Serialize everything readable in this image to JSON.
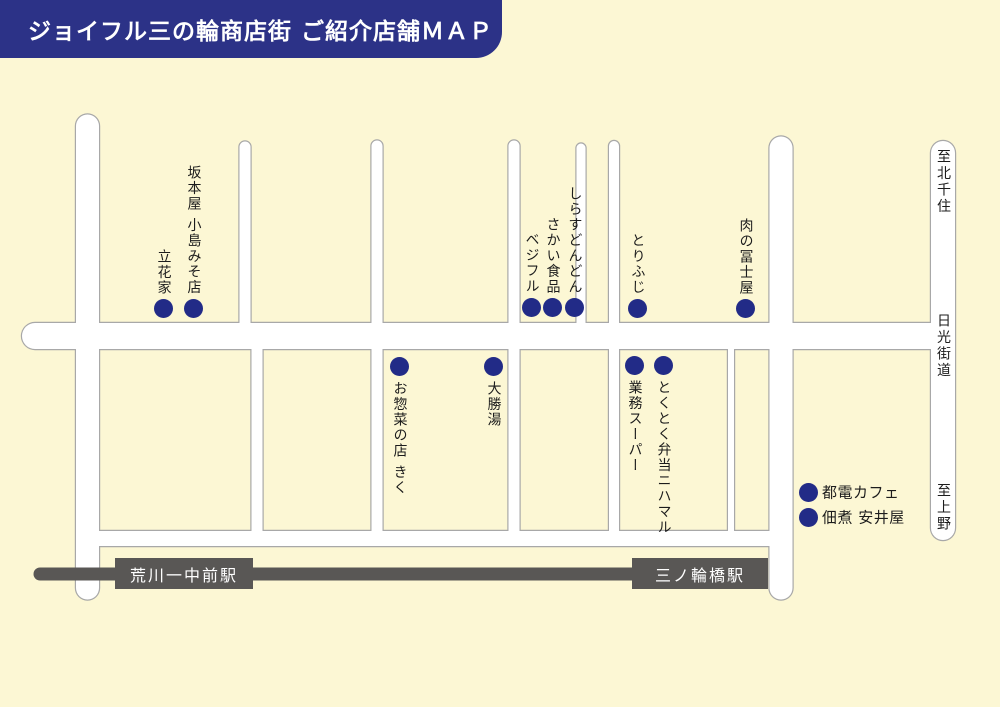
{
  "header": {
    "title": "ジョイフル三の輪商店街 ご紹介店舗ＭＡＰ"
  },
  "colors": {
    "background": "#fcf7d4",
    "dot_navy": "#222b87",
    "header_navy": "#2c3287",
    "road_fill": "#ffffff",
    "road_casing": "#a8a8a8",
    "rail_gray": "#595755",
    "label_ink": "#1c1c1c",
    "station_text": "#ffffff"
  },
  "stores": [
    {
      "name": "立花家",
      "dot_x": 163,
      "dot_y": 308,
      "label_style": "vertical-above"
    },
    {
      "name": "坂本屋 小島みそ店",
      "dot_x": 193,
      "dot_y": 308,
      "label_style": "vertical-above"
    },
    {
      "name": "ベジフル",
      "dot_x": 531,
      "dot_y": 307,
      "label_style": "vertical-above"
    },
    {
      "name": "さかい食品",
      "dot_x": 552,
      "dot_y": 307,
      "label_style": "vertical-above"
    },
    {
      "name": "しらすどんどん",
      "dot_x": 574,
      "dot_y": 307,
      "label_style": "vertical-above"
    },
    {
      "name": "とりふじ",
      "dot_x": 637,
      "dot_y": 308,
      "label_style": "vertical-above"
    },
    {
      "name": "肉の冨士屋",
      "dot_x": 745,
      "dot_y": 308,
      "label_style": "vertical-above"
    },
    {
      "name": "お惣菜の店 きく",
      "dot_x": 399,
      "dot_y": 366,
      "label_style": "vertical-below"
    },
    {
      "name": "大勝湯",
      "dot_x": 493,
      "dot_y": 366,
      "label_style": "vertical-below"
    },
    {
      "name": "業務スーパー",
      "dot_x": 634,
      "dot_y": 365,
      "label_style": "vertical-below"
    },
    {
      "name": "とくとく弁当ニハマル",
      "dot_x": 663,
      "dot_y": 365,
      "label_style": "vertical-below"
    },
    {
      "name": "都電カフェ",
      "dot_x": 808,
      "dot_y": 492,
      "label_style": "horizontal-right"
    },
    {
      "name": "佃煮 安井屋",
      "dot_x": 808,
      "dot_y": 517,
      "label_style": "horizontal-right"
    }
  ],
  "rail": {
    "stations": [
      {
        "name": "荒川一中前駅"
      },
      {
        "name": "三ノ輪橋駅"
      }
    ]
  },
  "road_labels": [
    {
      "text": "至北千住"
    },
    {
      "text": "日光街道"
    },
    {
      "text": "至上野"
    }
  ]
}
